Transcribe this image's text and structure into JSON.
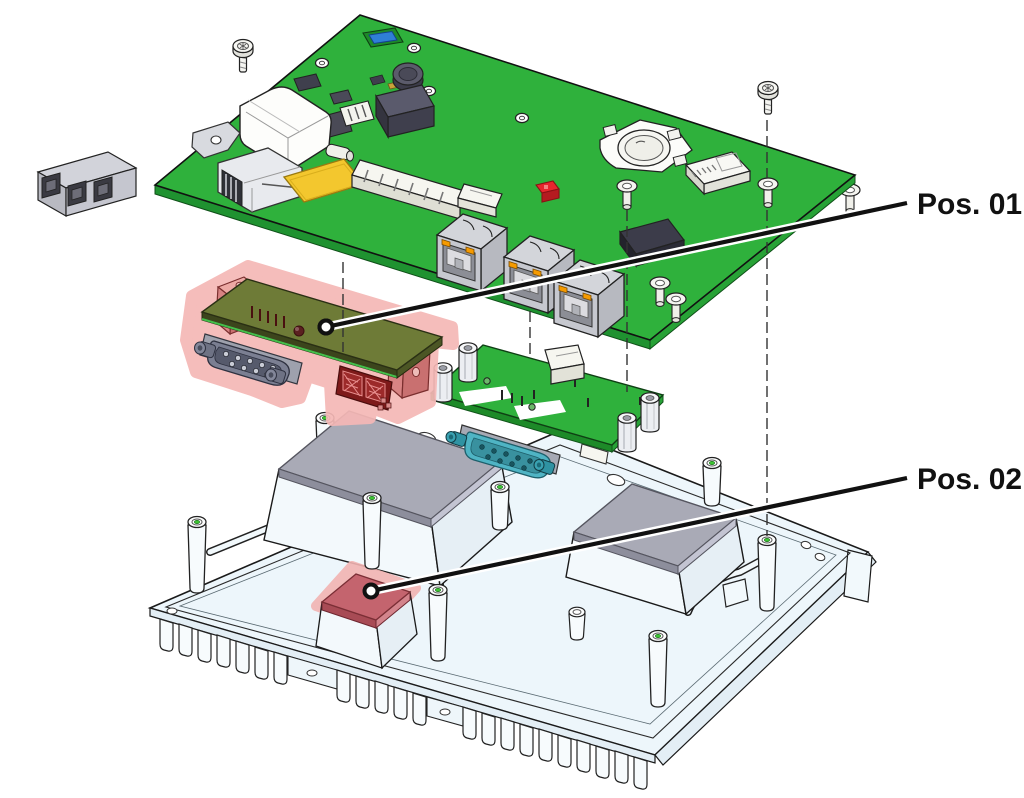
{
  "diagram": {
    "type": "exploded-assembly-illustration",
    "background": "#ffffff",
    "callouts": [
      {
        "id": "pos-01",
        "label": "Pos. 01",
        "target": "serial-adapter-board",
        "leader": {
          "from": [
            326,
            327
          ],
          "to": [
            907,
            203
          ]
        }
      },
      {
        "id": "pos-02",
        "label": "Pos. 02",
        "target": "thermal-pad-small",
        "leader": {
          "from": [
            371,
            591
          ],
          "to": [
            907,
            478
          ]
        }
      }
    ],
    "parts": [
      "main-board",
      "power-connector",
      "terminal-block",
      "usb-connector",
      "pin-headers",
      "coin-cell-battery-holder",
      "microsd-slot",
      "rj45-jack-1",
      "rj45-jack-2",
      "rj45-jack-3",
      "mounting-screw-1",
      "mounting-screw-2",
      "washer-spacer-1",
      "washer-spacer-2",
      "serial-adapter-board",
      "db9-connector-gray",
      "mezzanine-connector",
      "mounting-bracket-left",
      "mounting-bracket-right",
      "io-board",
      "db9-connector-teal",
      "hex-standoffs",
      "heatsink-chassis",
      "cooling-fins",
      "thermal-pad-large-left",
      "thermal-pad-large-right",
      "thermal-pad-small",
      "mounting-posts",
      "stiffening-ribs"
    ],
    "colors": {
      "pcb_green": "#2fb13c",
      "pcb_green_edge": "#1f9230",
      "pcb_olive": "#6e7b37",
      "highlight_pink": "#f5b8b6",
      "bracket_red": "#d88383",
      "thermal_pad_gray": "#a9aab6",
      "thermal_pad_red": "#c4646e",
      "heatsink_body": "#edf6fb",
      "connector_gray": "#c9cad2",
      "dsub_gray_blue": "#7b7f92",
      "dsub_teal": "#4fb4c4",
      "led_orange": "#f59a00",
      "component_red": "#e8262d",
      "component_blue": "#2f7fd6",
      "component_yellow": "#f3c72e",
      "screw_silver": "#f2f2ee",
      "outline": "#1a1a1a",
      "leader_line": "#111111",
      "post_hole_green": "#3ec433"
    }
  }
}
